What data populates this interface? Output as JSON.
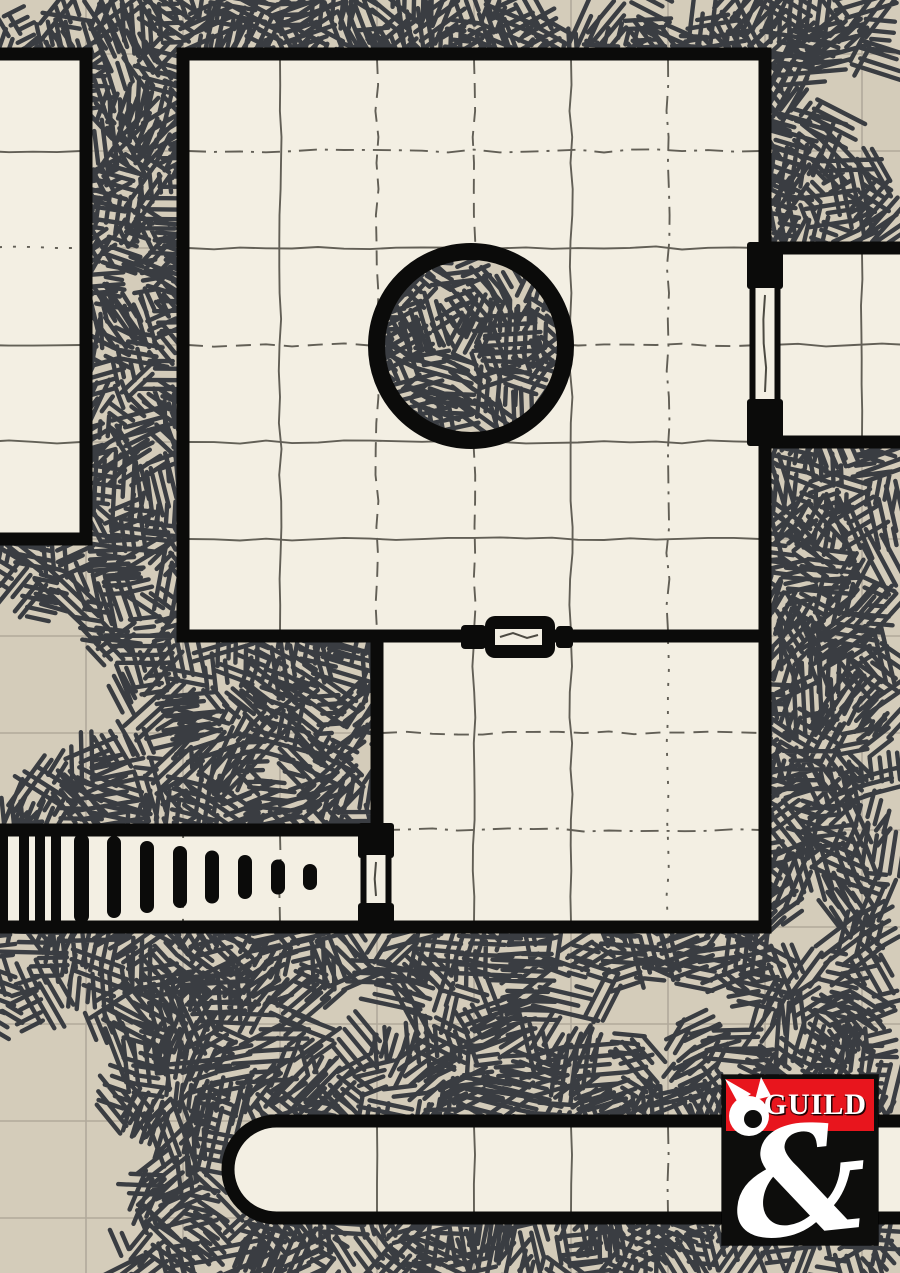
{
  "map": {
    "width": 900,
    "height": 1273,
    "colors": {
      "background": "#d4ccba",
      "floor": "#f3efe3",
      "wall": "#0b0b0a",
      "hatch": "#3a3d42",
      "grid_outside": "#9e978b",
      "grid_inside": "#5b584f",
      "door_line": "#4c4a42"
    },
    "grid": {
      "pitch": 97,
      "origin_x": 183,
      "origin_y": 54
    },
    "rooms": [
      {
        "name": "west-room",
        "x": -20,
        "y": 54,
        "w": 106,
        "h": 485
      },
      {
        "name": "main-hall",
        "x": 183,
        "y": 54,
        "w": 582,
        "h": 582
      },
      {
        "name": "east-room",
        "x": 765,
        "y": 248,
        "w": 150,
        "h": 194
      },
      {
        "name": "south-room",
        "x": 377,
        "y": 636,
        "w": 388,
        "h": 291
      },
      {
        "name": "stairs-corridor",
        "x": -15,
        "y": 830,
        "w": 392,
        "h": 97
      },
      {
        "name": "south-corridor",
        "x": 228,
        "y": 1121,
        "w": 687,
        "h": 97,
        "cap": "left"
      }
    ],
    "hatch_anchors": [
      {
        "x": 765,
        "y": -30,
        "w": 200,
        "h": 40
      },
      {
        "x": 877,
        "y": 440,
        "w": 60,
        "h": 690
      }
    ],
    "pillar": {
      "cx": 471,
      "cy": 346,
      "outer_radius": 103,
      "ring_width": 17
    },
    "stairs": {
      "full_bars_x": [
        -2,
        19,
        35,
        51
      ],
      "full_bar_width": 10,
      "wide_bar": {
        "x": 74,
        "width": 15
      },
      "tapered_width": 14,
      "center_y": 877,
      "tapered_bars": [
        {
          "x": 107,
          "h": 82
        },
        {
          "x": 140,
          "h": 72
        },
        {
          "x": 173,
          "h": 62
        },
        {
          "x": 205,
          "h": 53
        },
        {
          "x": 238,
          "h": 44
        },
        {
          "x": 271,
          "h": 35
        },
        {
          "x": 303,
          "h": 26
        }
      ]
    },
    "doors": [
      {
        "name": "east-door",
        "orient": "v",
        "style": "framed",
        "cx": 765,
        "posts": [
          [
            242,
            289
          ],
          [
            399,
            446
          ]
        ],
        "leaf": [
          285,
          402
        ]
      },
      {
        "name": "stairs-door",
        "orient": "v",
        "style": "framed",
        "cx": 376,
        "posts": [
          [
            823,
            858
          ],
          [
            903,
            931
          ]
        ],
        "leaf": [
          852,
          906
        ]
      },
      {
        "name": "south-door",
        "orient": "h",
        "style": "latch",
        "cx": 519,
        "cy": 637
      }
    ]
  },
  "logo": {
    "text": "GUILD",
    "ampersand": "&",
    "x": 722,
    "y": 1075,
    "width": 156,
    "height": 170,
    "banner_color": "#e8151d",
    "background_color": "#0d0d0c",
    "text_color": "#ffffff"
  }
}
